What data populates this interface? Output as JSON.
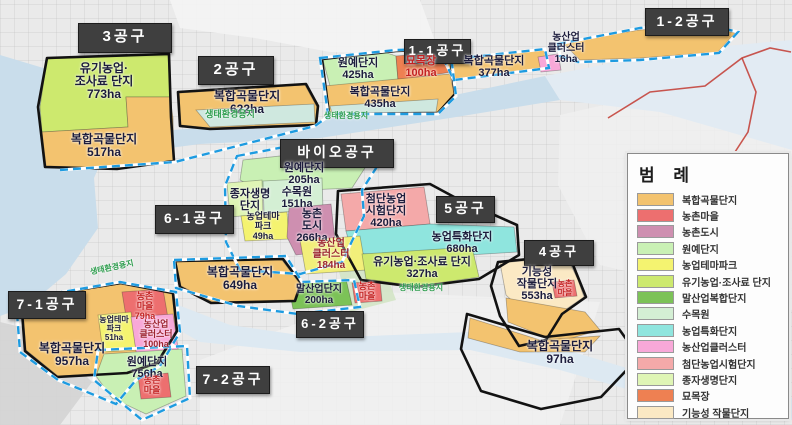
{
  "legend": {
    "title": "범 례",
    "items": [
      {
        "label": "복합곡물단지",
        "color": "#f3c36f"
      },
      {
        "label": "농촌마을",
        "color": "#ed6f6f"
      },
      {
        "label": "농촌도시",
        "color": "#ce8fb0"
      },
      {
        "label": "원예단지",
        "color": "#c9f0b4"
      },
      {
        "label": "농업테마파크",
        "color": "#f4f370"
      },
      {
        "label": "유기농업·조사료 단지",
        "color": "#cde96e"
      },
      {
        "label": "말산업복합단지",
        "color": "#7cc257"
      },
      {
        "label": "수목원",
        "color": "#d4efd4"
      },
      {
        "label": "농업특화단지",
        "color": "#8fe5de"
      },
      {
        "label": "농산업클러스터",
        "color": "#f8a8d8"
      },
      {
        "label": "첨단농업시험단지",
        "color": "#f4a9a9"
      },
      {
        "label": "종자생명단지",
        "color": "#dff5b5"
      },
      {
        "label": "묘목장",
        "color": "#ee8052"
      },
      {
        "label": "기능성 작물단지",
        "color": "#fbe9c4"
      }
    ]
  },
  "map": {
    "colors": {
      "outline": "#121212",
      "dashed": "#1e9be0",
      "red_line": "#c23a30",
      "label": "#1c1c3c",
      "red_label": "#c32222",
      "darkred_label": "#9c2430",
      "green_label": "#2f9e4f",
      "water": "#c9ddeb"
    },
    "terrain": [
      {
        "id": "urban-top",
        "points": "170,0 420,0 440,55 330,52 255,38 180,28",
        "color": "#f4f4f4",
        "opacity": 0.9
      },
      {
        "id": "plain-right",
        "points": "560,115 792,62 792,310 600,265 558,185",
        "color": "#f0f0f0",
        "opacity": 0.85
      },
      {
        "id": "plain-bottom",
        "points": "200,360 380,292 600,302 560,425 200,425",
        "color": "#f1f1f1",
        "opacity": 0.85
      },
      {
        "id": "park-green",
        "points": "338,268 382,262 396,300 350,312",
        "color": "#cfe3c0",
        "opacity": 0.8
      },
      {
        "id": "road-corner",
        "points": "0,322 42,332 92,382 60,425 0,425",
        "color": "#d4d4d4",
        "opacity": 0.9
      }
    ],
    "water": [
      {
        "id": "water-topleft",
        "points": "0,55 70,76 102,96 114,132 94,178 98,228 66,274 28,306 0,316",
        "color": "#c9ddeb"
      },
      {
        "id": "river-main",
        "points": "92,136 200,128 320,120 450,96 545,76 560,100 450,118 320,138 200,144 94,158",
        "color": "#c9ddeb"
      },
      {
        "id": "river-wide-right",
        "points": "545,76 680,50 792,40 792,150 660,112 560,100",
        "color": "#e2ebf3"
      },
      {
        "id": "river-bottom",
        "points": "165,300 230,325 320,338 470,332 540,342 640,372 720,392 792,398 792,420 700,410 560,370 470,350 300,352 200,342 158,318",
        "color": "#dde9f2"
      }
    ],
    "zones": [
      {
        "id": "organic-773",
        "color": "#cde96e",
        "points": "40,107 47,59 168,54 170,97 126,97 128,127 42,132"
      },
      {
        "id": "grain-517",
        "color": "#f3c36f",
        "points": "42,132 128,127 126,97 170,97 173,118 174,160 118,168 46,166"
      },
      {
        "id": "grain-622",
        "color": "#f3c36f",
        "points": "179,93 305,85 317,107 315,124 210,128 181,125"
      },
      {
        "id": "eco-strip-2",
        "color": "#cfe8df",
        "points": "196,110 314,104 315,122 210,127"
      },
      {
        "id": "hort-425",
        "color": "#c9f0b4",
        "points": "323,60 384,52 396,56 398,80 330,86"
      },
      {
        "id": "nursery-100",
        "color": "#ee8052",
        "points": "396,56 446,52 452,72 398,80"
      },
      {
        "id": "grain-435",
        "color": "#f3c36f",
        "points": "324,86 450,74 454,94 438,112 330,113"
      },
      {
        "id": "eco-strip-11",
        "color": "#cfe8df",
        "points": "330,106 438,99 436,112 332,113"
      },
      {
        "id": "grain-377",
        "color": "#f3c36f",
        "points": "446,60 544,50 548,67 453,79"
      },
      {
        "id": "cluster-16",
        "color": "#f8a8d8",
        "points": "538,57 558,54 561,70 541,72"
      },
      {
        "id": "grain-islands-12",
        "color": "#f3c36f",
        "points": "562,42 640,30 700,26 735,33 718,52 640,58 580,60"
      },
      {
        "id": "hort-205",
        "color": "#c9f0b4",
        "points": "243,160 345,149 370,160 352,188 262,192 240,180"
      },
      {
        "id": "seed-life",
        "color": "#dff5b5",
        "points": "227,183 262,180 263,214 230,217"
      },
      {
        "id": "arboretum-151",
        "color": "#d4efd4",
        "points": "263,181 322,178 323,210 264,213"
      },
      {
        "id": "theme-49",
        "color": "#f4f370",
        "points": "241,216 287,212 289,239 245,241"
      },
      {
        "id": "city-266",
        "color": "#ce8fb0",
        "points": "289,208 331,204 336,250 296,255 287,237"
      },
      {
        "id": "advanced-420",
        "color": "#f4a9a9",
        "points": "341,194 424,187 430,224 346,231"
      },
      {
        "id": "special-680",
        "color": "#8fe5de",
        "points": "346,231 430,224 514,227 517,252 420,258 352,253"
      },
      {
        "id": "cluster-184",
        "color": "#f2ef7a",
        "points": "300,240 360,236 366,270 306,274"
      },
      {
        "id": "organic-327",
        "color": "#cde96e",
        "points": "362,254 472,247 479,277 417,286 366,279"
      },
      {
        "id": "horse-200",
        "color": "#7cc257",
        "points": "288,284 346,279 352,305 293,309"
      },
      {
        "id": "village-center",
        "color": "#ed6f6f",
        "points": "352,283 380,281 382,301 355,303"
      },
      {
        "id": "functional-553",
        "color": "#fbe9c4",
        "points": "500,263 567,257 578,280 584,297 562,312 530,318 506,295"
      },
      {
        "id": "village-4",
        "color": "#ed6f6f",
        "points": "552,282 574,280 577,296 555,298"
      },
      {
        "id": "grain-strip-4a",
        "color": "#f3c36f",
        "points": "506,298 585,312 600,330 558,342 508,322"
      },
      {
        "id": "grain-strip-4b",
        "color": "#f3c36f",
        "points": "470,318 540,340 600,336 585,352 520,352 468,338"
      },
      {
        "id": "grain-649",
        "color": "#f3c36f",
        "points": "176,262 282,260 300,284 294,300 212,302 181,286"
      },
      {
        "id": "grain-957",
        "color": "#f3c36f",
        "points": "22,300 120,284 172,294 176,330 158,362 128,372 58,376 26,350"
      },
      {
        "id": "village-79",
        "color": "#ed6f6f",
        "points": "122,292 163,289 169,324 128,329"
      },
      {
        "id": "theme-51",
        "color": "#f4f370",
        "points": "98,315 131,312 136,350 103,352"
      },
      {
        "id": "cluster-100",
        "color": "#f8a8d8",
        "points": "131,317 173,314 179,355 137,358"
      },
      {
        "id": "hort-756",
        "color": "#c9f0b4",
        "points": "104,354 182,349 186,396 146,414 112,398 96,376"
      },
      {
        "id": "village-bottomleft",
        "color": "#ed6f6f",
        "points": "138,376 168,373 171,397 141,399"
      }
    ],
    "boundaries": [
      {
        "style": "black",
        "points": "38,107 47,58 169,54 171,117 174,161 117,169 45,167"
      },
      {
        "style": "black",
        "points": "178,92 306,84 318,106 316,125 210,129 180,126"
      },
      {
        "style": "black",
        "points": "322,59 396,51 449,49 455,94 438,113 329,114"
      },
      {
        "style": "black",
        "points": "338,191 430,184 456,198 517,225 519,255 479,279 416,287 361,280 336,234"
      },
      {
        "style": "black",
        "points": "498,262 569,255 586,297 562,314 546,340 519,346 500,316 491,286"
      },
      {
        "style": "black",
        "points": "467,314 545,337 619,329 639,357 601,397 541,409 481,391 461,349"
      },
      {
        "style": "black",
        "points": "175,261 283,259 301,283 295,301 211,303 180,287"
      },
      {
        "style": "black",
        "points": "21,299 121,283 173,293 177,331 157,363 127,373 57,377 25,351"
      },
      {
        "style": "dashed",
        "points": "444,60 545,49 549,68 454,80"
      },
      {
        "style": "dashed",
        "points": "558,44 640,28 704,24 738,32 719,53 640,60 578,62 560,56"
      },
      {
        "style": "dashed",
        "points": "237,156 300,144 372,150 380,162 362,190 364,216 342,262 300,274 240,270 226,242 225,186"
      },
      {
        "style": "dashed",
        "points": "320,58 396,50 450,48 456,96 438,114 328,114"
      },
      {
        "style": "dashed",
        "points": "16,300 120,282 176,292 180,332 160,366 136,380 116,404 58,380 20,352"
      },
      {
        "style": "dashed",
        "points": "174,260 286,256 302,282 354,280 360,307 298,314 238,306 176,288"
      },
      {
        "style": "dashed",
        "points": "98,350 187,346 190,398 142,420 94,380"
      },
      {
        "style": "dashed",
        "open": true,
        "points": "60,170 175,162 315,126 330,115"
      }
    ],
    "red_boundary": [
      {
        "points": "608,118 650,92 705,86 742,58 770,48 791,52"
      },
      {
        "points": "742,58 756,92 748,132 722,172 700,210"
      }
    ],
    "district_labels": [
      {
        "text": "3공구",
        "x": 78,
        "y": 23,
        "w": 92,
        "h": 28,
        "fs": 15
      },
      {
        "text": "2공구",
        "x": 198,
        "y": 56,
        "w": 74,
        "h": 27,
        "fs": 15
      },
      {
        "text": "1-1공구",
        "x": 404,
        "y": 39,
        "w": 65,
        "h": 23,
        "fs": 13
      },
      {
        "text": "1-2공구",
        "x": 645,
        "y": 8,
        "w": 82,
        "h": 26,
        "fs": 14
      },
      {
        "text": "바이오공구",
        "x": 280,
        "y": 139,
        "w": 112,
        "h": 27,
        "fs": 14
      },
      {
        "text": "6-1공구",
        "x": 155,
        "y": 205,
        "w": 77,
        "h": 27,
        "fs": 14
      },
      {
        "text": "5공구",
        "x": 436,
        "y": 196,
        "w": 57,
        "h": 25,
        "fs": 14
      },
      {
        "text": "4공구",
        "x": 524,
        "y": 240,
        "w": 68,
        "h": 24,
        "fs": 13
      },
      {
        "text": "7-1공구",
        "x": 8,
        "y": 291,
        "w": 76,
        "h": 26,
        "fs": 14
      },
      {
        "text": "6-2공구",
        "x": 296,
        "y": 311,
        "w": 66,
        "h": 25,
        "fs": 13
      },
      {
        "text": "7-2공구",
        "x": 196,
        "y": 366,
        "w": 72,
        "h": 26,
        "fs": 14
      }
    ],
    "labels": [
      {
        "lines": [
          "유기농업·",
          "조사료 단지",
          "773ha"
        ],
        "x": 104,
        "y": 62,
        "size": 12
      },
      {
        "lines": [
          "복합곡물단지",
          "517ha"
        ],
        "x": 104,
        "y": 133,
        "size": 12
      },
      {
        "lines": [
          "복합곡물단지",
          "622ha"
        ],
        "x": 247,
        "y": 90,
        "size": 12
      },
      {
        "lines": [
          "생태환경용지"
        ],
        "x": 230,
        "y": 110,
        "size": 9,
        "color": "#2f9e4f"
      },
      {
        "lines": [
          "원예단지",
          "425ha"
        ],
        "x": 358,
        "y": 57,
        "size": 11
      },
      {
        "lines": [
          "묘목장",
          "100ha"
        ],
        "x": 421,
        "y": 55,
        "size": 11,
        "color": "#c32222"
      },
      {
        "lines": [
          "복합곡물단지",
          "435ha"
        ],
        "x": 380,
        "y": 86,
        "size": 11
      },
      {
        "lines": [
          "생태환경용지"
        ],
        "x": 346,
        "y": 112,
        "size": 8,
        "color": "#2f9e4f"
      },
      {
        "lines": [
          "복합곡물단지",
          "377ha"
        ],
        "x": 494,
        "y": 55,
        "size": 11
      },
      {
        "lines": [
          "농산업",
          "클러스터",
          "16ha"
        ],
        "x": 566,
        "y": 32,
        "size": 10
      },
      {
        "lines": [
          "원예단지",
          "205ha"
        ],
        "x": 304,
        "y": 162,
        "size": 11
      },
      {
        "lines": [
          "종자생명",
          "단지"
        ],
        "x": 250,
        "y": 188,
        "size": 11
      },
      {
        "lines": [
          "수목원",
          "151ha"
        ],
        "x": 297,
        "y": 186,
        "size": 11
      },
      {
        "lines": [
          "농업테마",
          "파크",
          "49ha"
        ],
        "x": 263,
        "y": 212,
        "size": 9
      },
      {
        "lines": [
          "농촌",
          "도시",
          "266ha"
        ],
        "x": 312,
        "y": 208,
        "size": 11
      },
      {
        "lines": [
          "첨단농업",
          "시험단지",
          "420ha"
        ],
        "x": 386,
        "y": 193,
        "size": 11
      },
      {
        "lines": [
          "농업특화단지",
          "680ha"
        ],
        "x": 462,
        "y": 231,
        "size": 11
      },
      {
        "lines": [
          "농산업",
          "클러스터",
          "184ha"
        ],
        "x": 331,
        "y": 238,
        "size": 10,
        "color": "#9c2430"
      },
      {
        "lines": [
          "유기농업·조사료 단지",
          "327ha"
        ],
        "x": 422,
        "y": 256,
        "size": 11
      },
      {
        "lines": [
          "말산업단지",
          "200ha"
        ],
        "x": 319,
        "y": 284,
        "size": 10
      },
      {
        "lines": [
          "농촌",
          "마을"
        ],
        "x": 367,
        "y": 282,
        "size": 9,
        "color": "#c32222"
      },
      {
        "lines": [
          "생태환경용지"
        ],
        "x": 421,
        "y": 284,
        "size": 8,
        "color": "#2f9e4f"
      },
      {
        "lines": [
          "생태환경용지"
        ],
        "x": 112,
        "y": 264,
        "size": 8,
        "color": "#2f9e4f",
        "rotate": -12
      },
      {
        "lines": [
          "복합곡물단지",
          "649ha"
        ],
        "x": 240,
        "y": 266,
        "size": 12
      },
      {
        "lines": [
          "복합곡물단지",
          "957ha"
        ],
        "x": 72,
        "y": 342,
        "size": 12
      },
      {
        "lines": [
          "농촌",
          "마을",
          "79ha"
        ],
        "x": 145,
        "y": 292,
        "size": 9,
        "color": "#c32222"
      },
      {
        "lines": [
          "농업테마",
          "파크",
          "51ha"
        ],
        "x": 114,
        "y": 316,
        "size": 8
      },
      {
        "lines": [
          "농산업",
          "클러스터",
          "100ha"
        ],
        "x": 156,
        "y": 320,
        "size": 9,
        "color": "#9c2430"
      },
      {
        "lines": [
          "원예단지",
          "756ha"
        ],
        "x": 147,
        "y": 356,
        "size": 11
      },
      {
        "lines": [
          "농촌",
          "마을"
        ],
        "x": 152,
        "y": 376,
        "size": 9,
        "color": "#c32222"
      },
      {
        "lines": [
          "기능성",
          "작물단지",
          "553ha"
        ],
        "x": 537,
        "y": 266,
        "size": 11
      },
      {
        "lines": [
          "농촌",
          "마을"
        ],
        "x": 565,
        "y": 280,
        "size": 8,
        "color": "#c32222"
      },
      {
        "lines": [
          "복합곡물단지",
          "97ha"
        ],
        "x": 560,
        "y": 340,
        "size": 12
      }
    ]
  }
}
